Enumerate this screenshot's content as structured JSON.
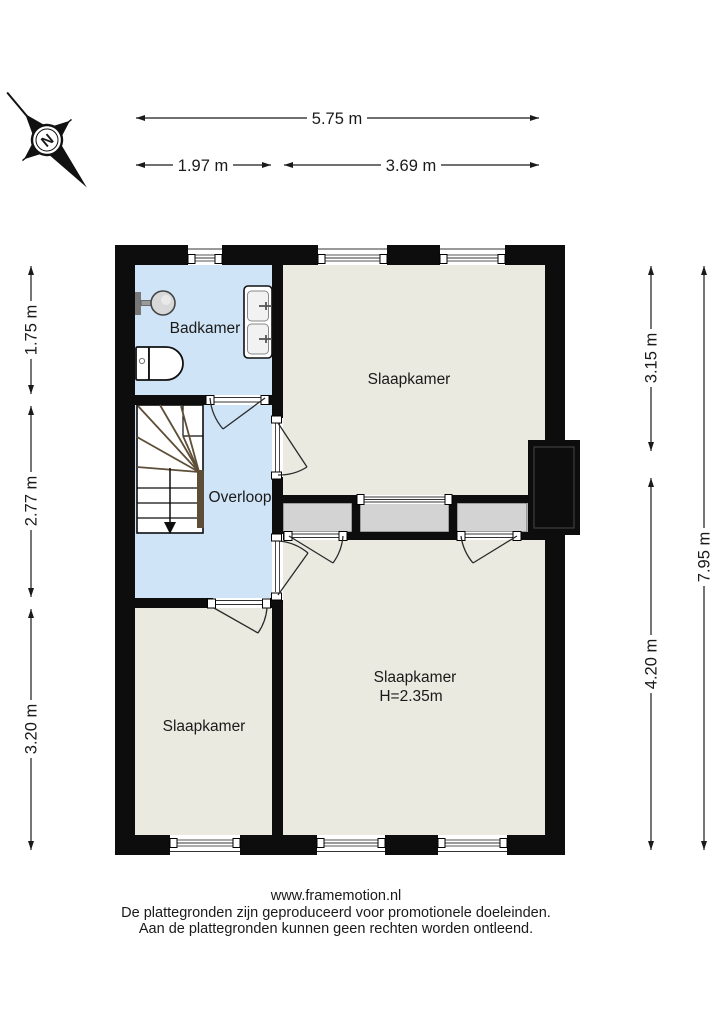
{
  "compass": {
    "label": "N"
  },
  "dimensions": {
    "top_total": "5.75 m",
    "top_left": "1.97 m",
    "top_right": "3.69 m",
    "left_top": "1.75 m",
    "left_middle": "2.77 m",
    "left_bottom": "3.20 m",
    "right_top": "3.15 m",
    "right_bottom": "4.20 m",
    "right_total": "7.95 m"
  },
  "rooms": {
    "bathroom": {
      "label": "Badkamer"
    },
    "landing": {
      "label": "Overloop"
    },
    "bedroom_top": {
      "label": "Slaapkamer"
    },
    "bedroom_left": {
      "label": "Slaapkamer"
    },
    "bedroom_main": {
      "label": "Slaapkamer",
      "ceiling_height": "H=2.35m"
    }
  },
  "colors": {
    "wet_room_floor": "#cfe4f7",
    "bedroom_floor": "#eaeae1",
    "closet_fill": "#d3d3d3",
    "stair_wood": "#5e4e38"
  },
  "footer": {
    "website": "www.framemotion.nl",
    "disclaimer_line1": "De plattegronden zijn geproduceerd voor promotionele doeleinden.",
    "disclaimer_line2": "Aan de plattegronden kunnen geen rechten worden ontleend."
  }
}
